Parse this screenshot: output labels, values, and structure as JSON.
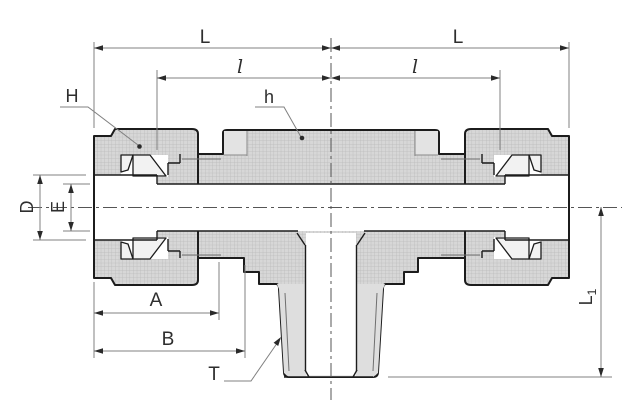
{
  "drawing": {
    "type": "technical-section-drawing",
    "subject": "compression tube fitting - male branch tee, cross-section with dimension callouts",
    "labels": {
      "length_left": "L",
      "length_right": "L",
      "insert_left": "l",
      "insert_right": "l",
      "nut_hex": "H",
      "body_hex": "h",
      "tube_od": "D",
      "bore": "E",
      "dim_a": "A",
      "dim_b": "B",
      "thread": "T",
      "branch_len_main": "L",
      "branch_len_sub": "1"
    },
    "colors": {
      "background": "#ffffff",
      "outline": "#1c1c1c",
      "section_fill": "#d7d7d7",
      "hatch_line": "#b9b9b9",
      "plain_surface": "#e3e3e3",
      "dimension_line": "#808080",
      "label_text": "#2e2e2e"
    }
  }
}
